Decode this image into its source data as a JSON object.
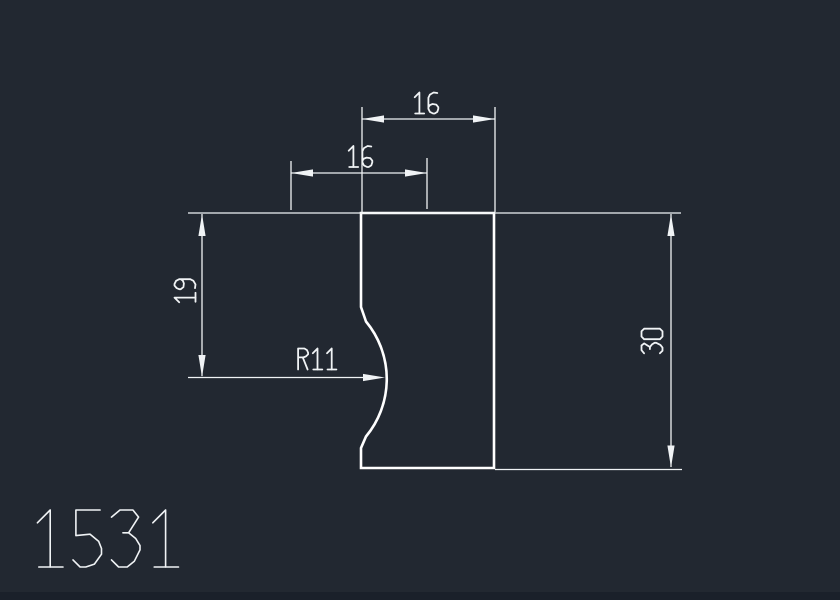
{
  "app": {
    "type": "cad-drawing-view",
    "canvas_width": 840,
    "canvas_height": 600
  },
  "colors": {
    "background": "#222831",
    "footer_strip": "#1a202a",
    "object_line": "#ffffff",
    "dimension_line": "#f0f3f5",
    "text": "#f0f3f5"
  },
  "drawing_number": {
    "text": "1531"
  },
  "part": {
    "description": "rectangular plate with semicircular notch on left edge",
    "width_value": "16",
    "height_value": "30",
    "notch_radius_value": "11"
  },
  "dimensions": [
    {
      "id": "top-width",
      "value": "16",
      "orientation": "horizontal"
    },
    {
      "id": "notch-offset",
      "value": "16",
      "orientation": "horizontal"
    },
    {
      "id": "left-height",
      "value": "19",
      "orientation": "vertical"
    },
    {
      "id": "right-height",
      "value": "30",
      "orientation": "vertical"
    },
    {
      "id": "notch-radius",
      "value": "R11",
      "orientation": "leader"
    }
  ]
}
